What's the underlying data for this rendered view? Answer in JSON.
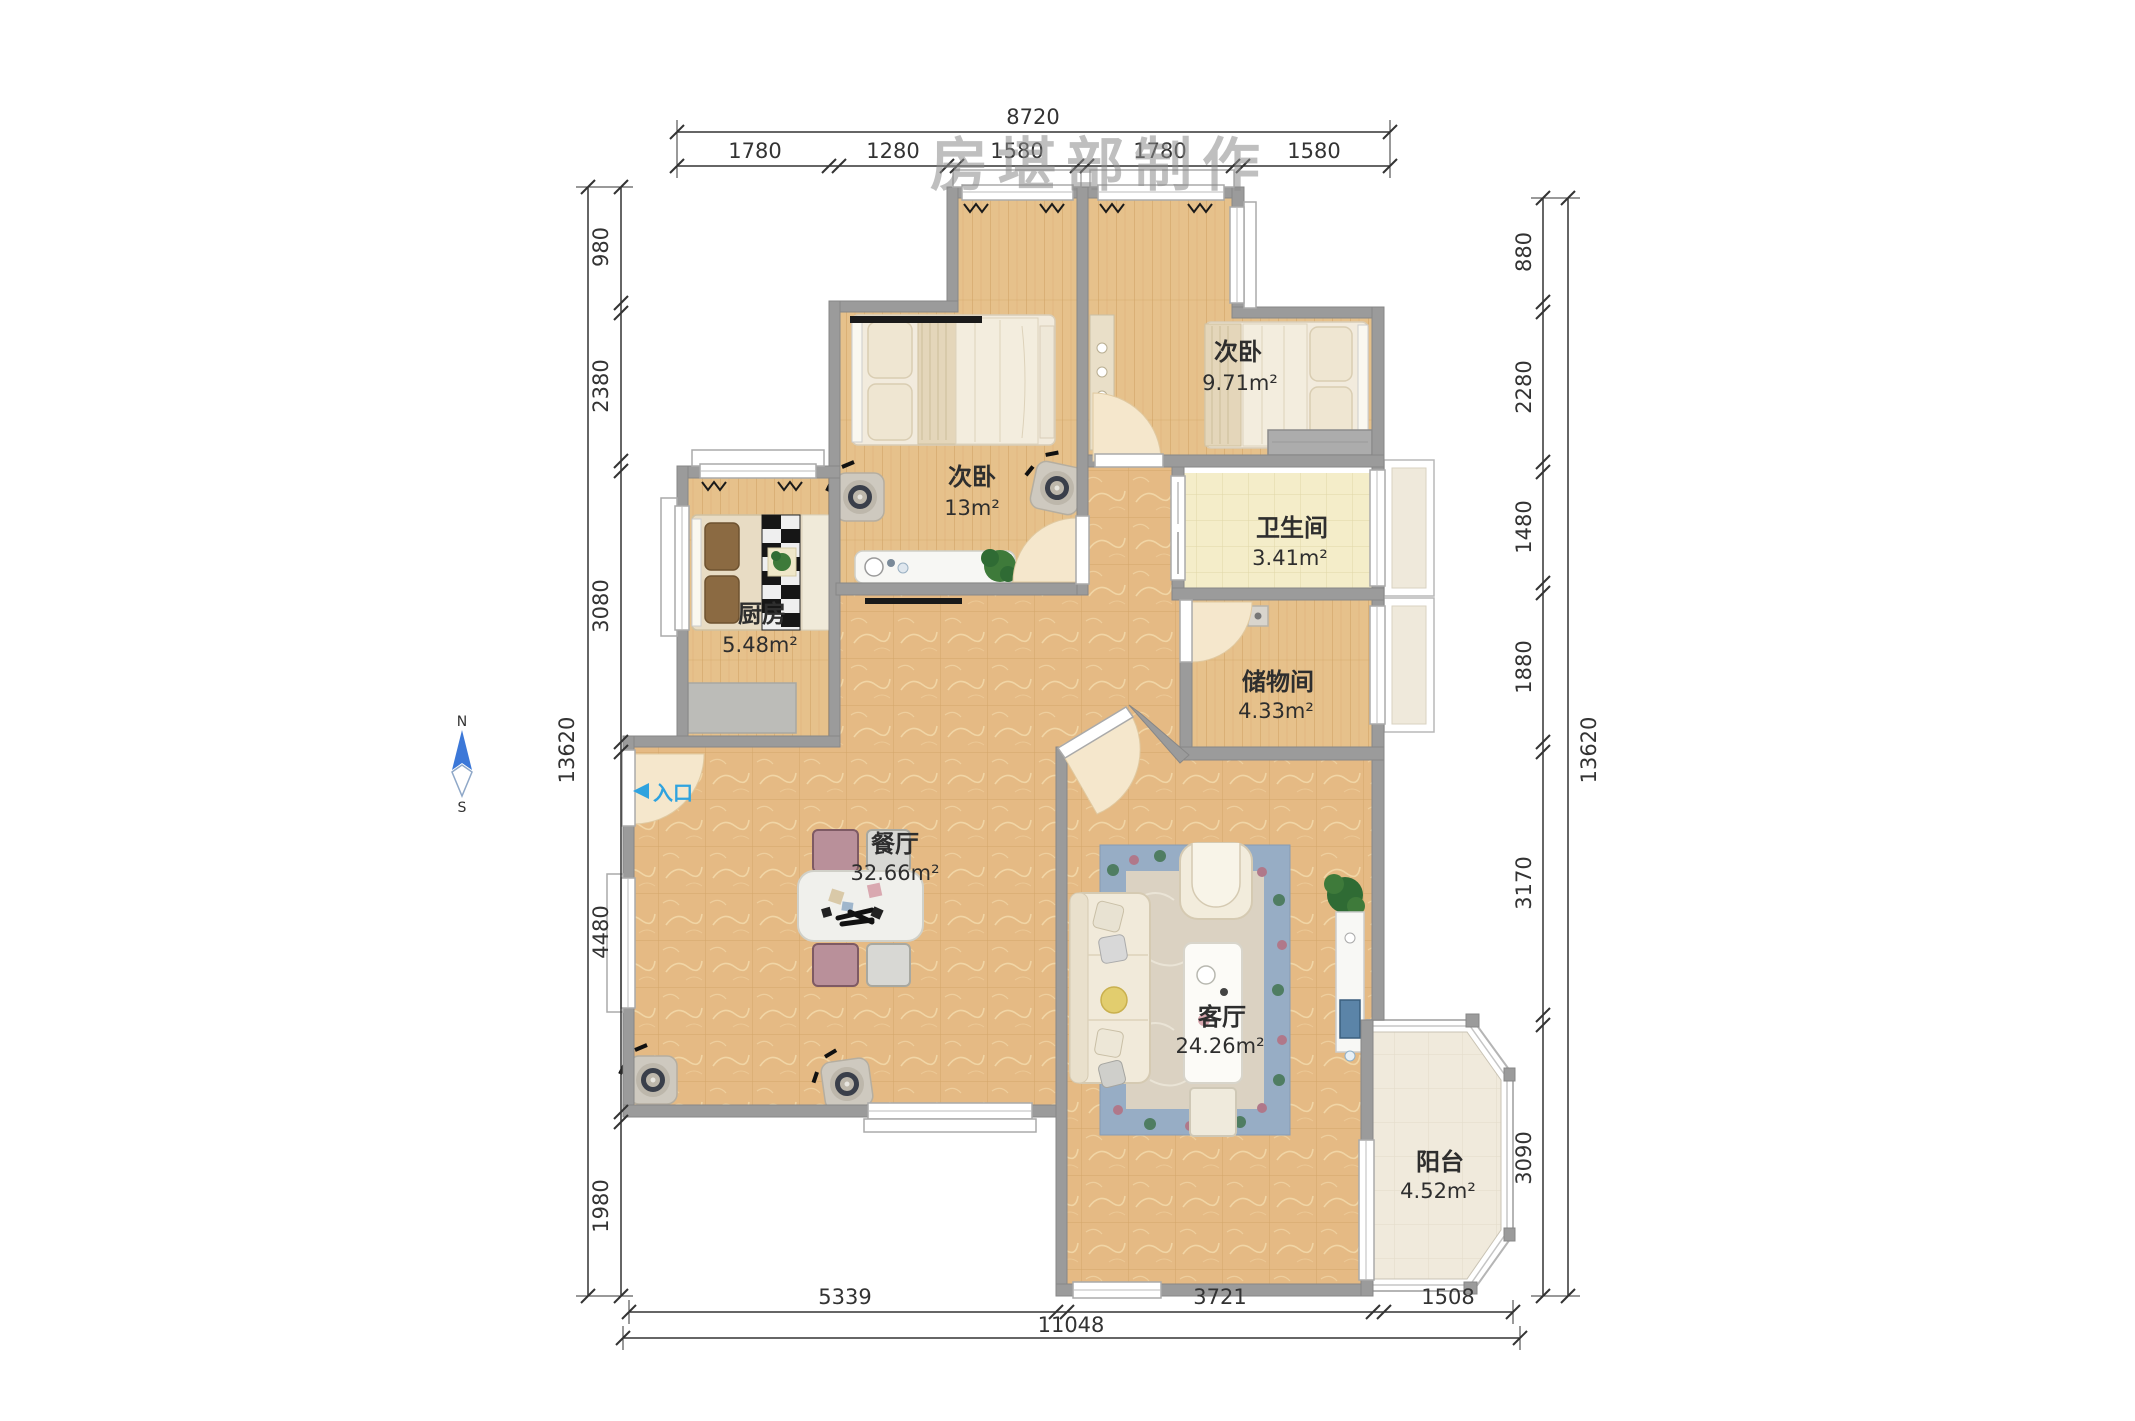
{
  "watermark": "房堪部制作",
  "compass": {
    "north": "N",
    "south": "S"
  },
  "entrance": {
    "label": "入口"
  },
  "rooms": {
    "bedroom1": {
      "name": "次卧",
      "area": "13m²"
    },
    "bedroom2": {
      "name": "次卧",
      "area": "9.71m²"
    },
    "bathroom": {
      "name": "卫生间",
      "area": "3.41m²"
    },
    "storage": {
      "name": "储物间",
      "area": "4.33m²"
    },
    "kitchen": {
      "name": "厨房",
      "area": "5.48m²"
    },
    "dining": {
      "name": "餐厅",
      "area": "32.66m²"
    },
    "living": {
      "name": "客厅",
      "area": "24.26m²"
    },
    "balcony": {
      "name": "阳台",
      "area": "4.52m²"
    }
  },
  "dimensions": {
    "top": {
      "total": "8720",
      "segments": [
        "1780",
        "1280",
        "1580",
        "1780",
        "1580"
      ]
    },
    "left": {
      "total": "13620",
      "segments": [
        "980",
        "2380",
        "3080",
        "4480",
        "1980"
      ]
    },
    "right": {
      "total": "13620",
      "segments": [
        "880",
        "2280",
        "1480",
        "1880",
        "3170",
        "3090"
      ]
    },
    "bottom": {
      "total": "11048",
      "segments": [
        "5339",
        "3721",
        "1508"
      ]
    }
  },
  "colors": {
    "wall": "#9b9b9b",
    "wood_floor": "#e6c18b",
    "tile_floor": "#e5ba84",
    "bath_floor": "#f4edc9",
    "balcony_floor": "#f0eadc",
    "accent_blue": "#2fa3df"
  }
}
